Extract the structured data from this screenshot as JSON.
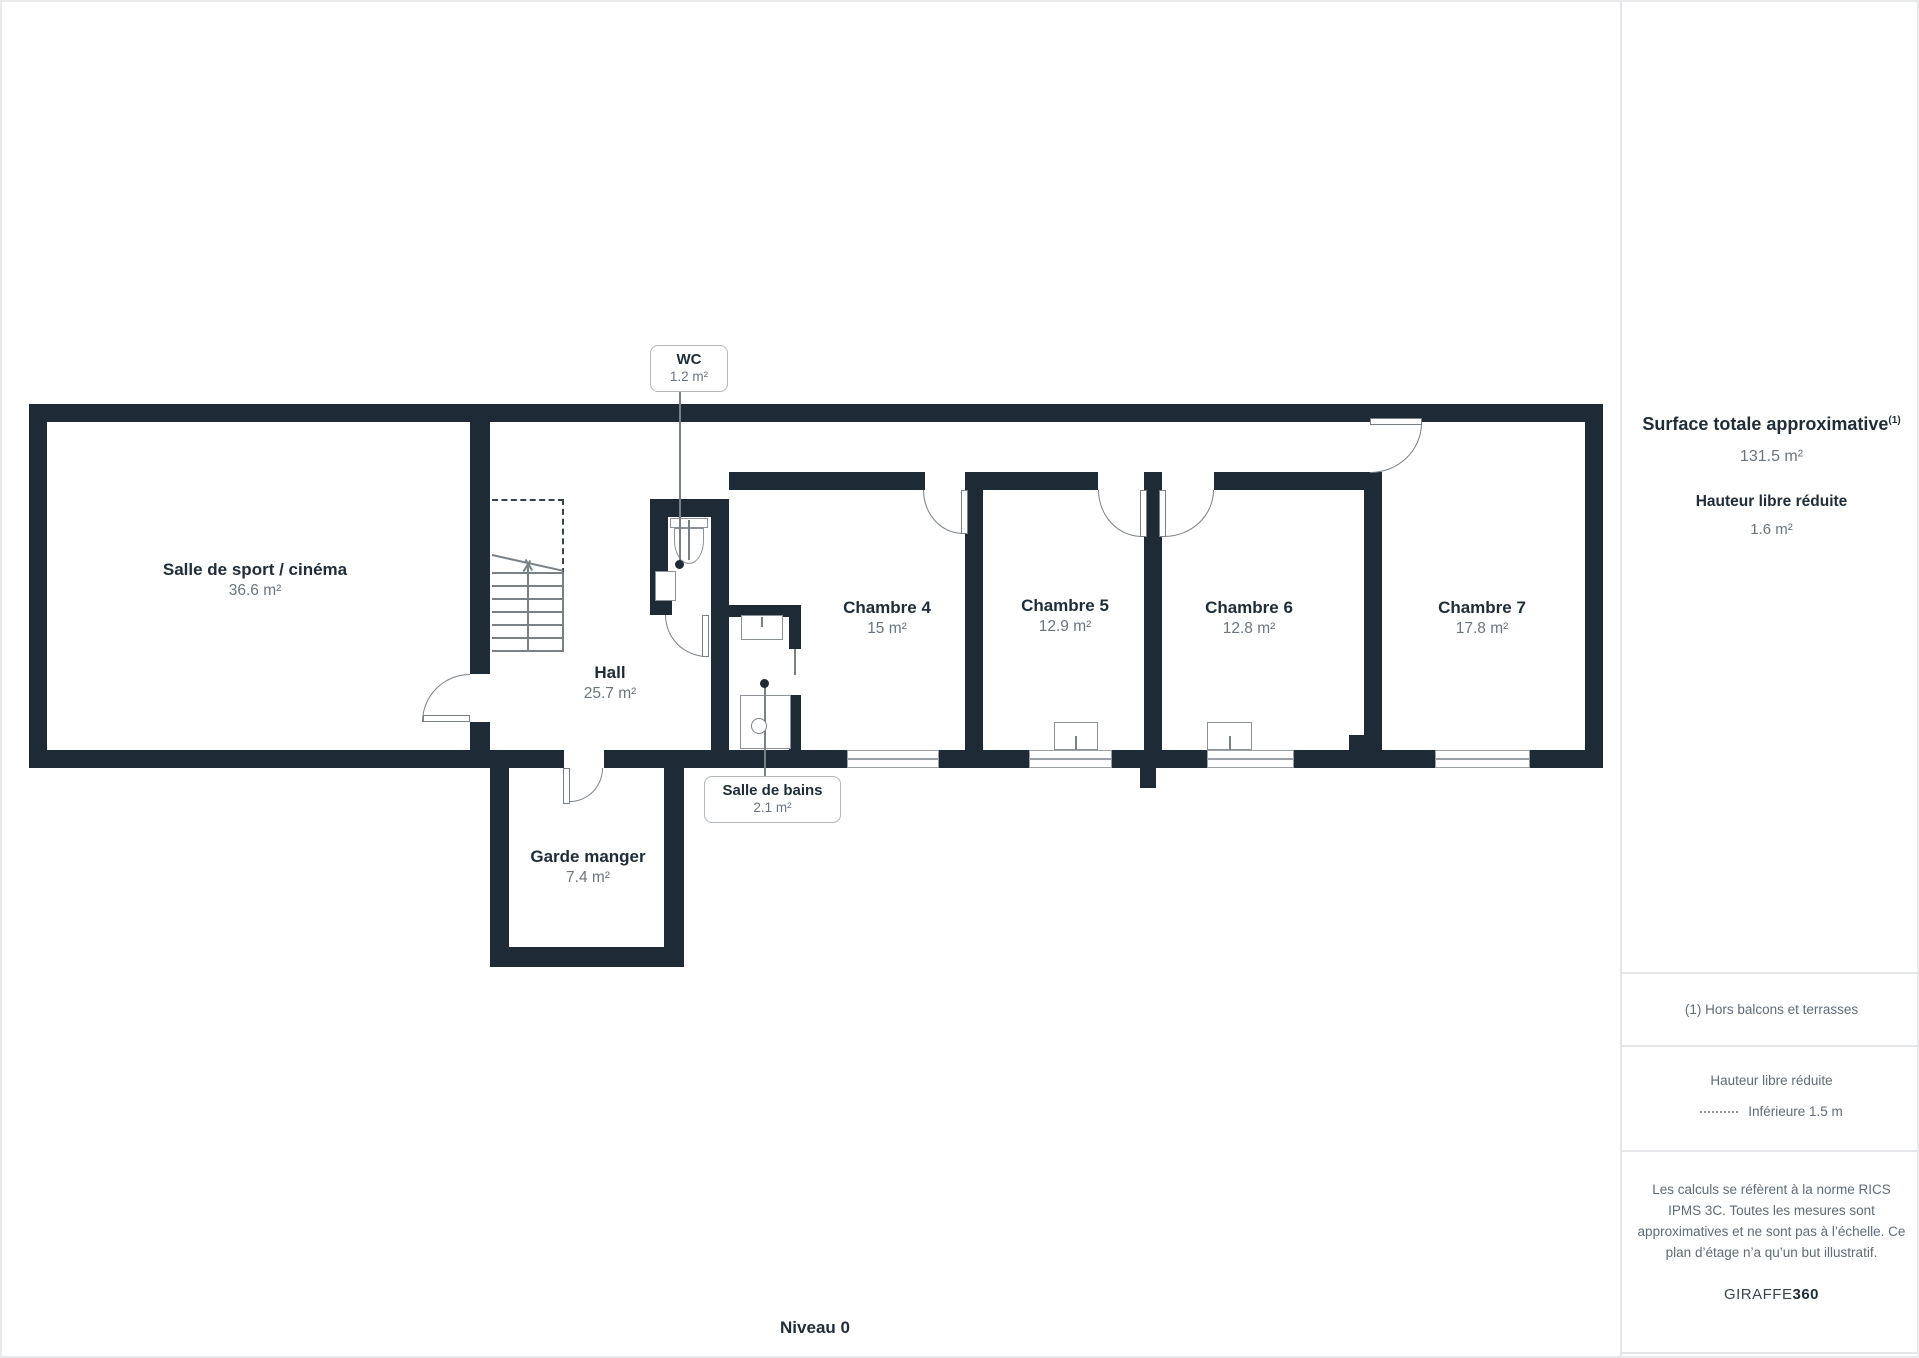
{
  "floorplan": {
    "level_label": "Niveau 0",
    "rooms": [
      {
        "id": "salle_sport",
        "name": "Salle de sport / cinéma",
        "area": "36.6 m²"
      },
      {
        "id": "hall",
        "name": "Hall",
        "area": "25.7 m²"
      },
      {
        "id": "wc",
        "name": "WC",
        "area": "1.2 m²"
      },
      {
        "id": "salle_bains",
        "name": "Salle de bains",
        "area": "2.1 m²"
      },
      {
        "id": "garde_manger",
        "name": "Garde manger",
        "area": "7.4 m²"
      },
      {
        "id": "chambre4",
        "name": "Chambre 4",
        "area": "15 m²"
      },
      {
        "id": "chambre5",
        "name": "Chambre 5",
        "area": "12.9 m²"
      },
      {
        "id": "chambre6",
        "name": "Chambre 6",
        "area": "12.8 m²"
      },
      {
        "id": "chambre7",
        "name": "Chambre 7",
        "area": "17.8 m²"
      }
    ]
  },
  "sidebar": {
    "total_label": "Surface totale approximative",
    "total_label_sup": "(1)",
    "total_value": "131.5 m²",
    "height_label": "Hauteur libre réduite",
    "height_value": "1.6 m²",
    "footnote": "(1) Hors balcons et terrasses",
    "legend_title": "Hauteur libre réduite",
    "legend_item": "Inférieure 1.5 m",
    "disclaimer": "Les calculs se réfèrent à la norme RICS IPMS 3C. Toutes les mesures sont approximatives et ne sont pas à l’échelle. Ce plan d’étage n’a qu’un but illustratif.",
    "brand_name": "GIRAFFE",
    "brand_suffix": "360"
  },
  "colors": {
    "wall": "#1e2a36",
    "text_dark": "#1f2c39",
    "text_gray": "#6a7480",
    "line_gray": "#798086",
    "border_light": "#e4e6e9"
  }
}
